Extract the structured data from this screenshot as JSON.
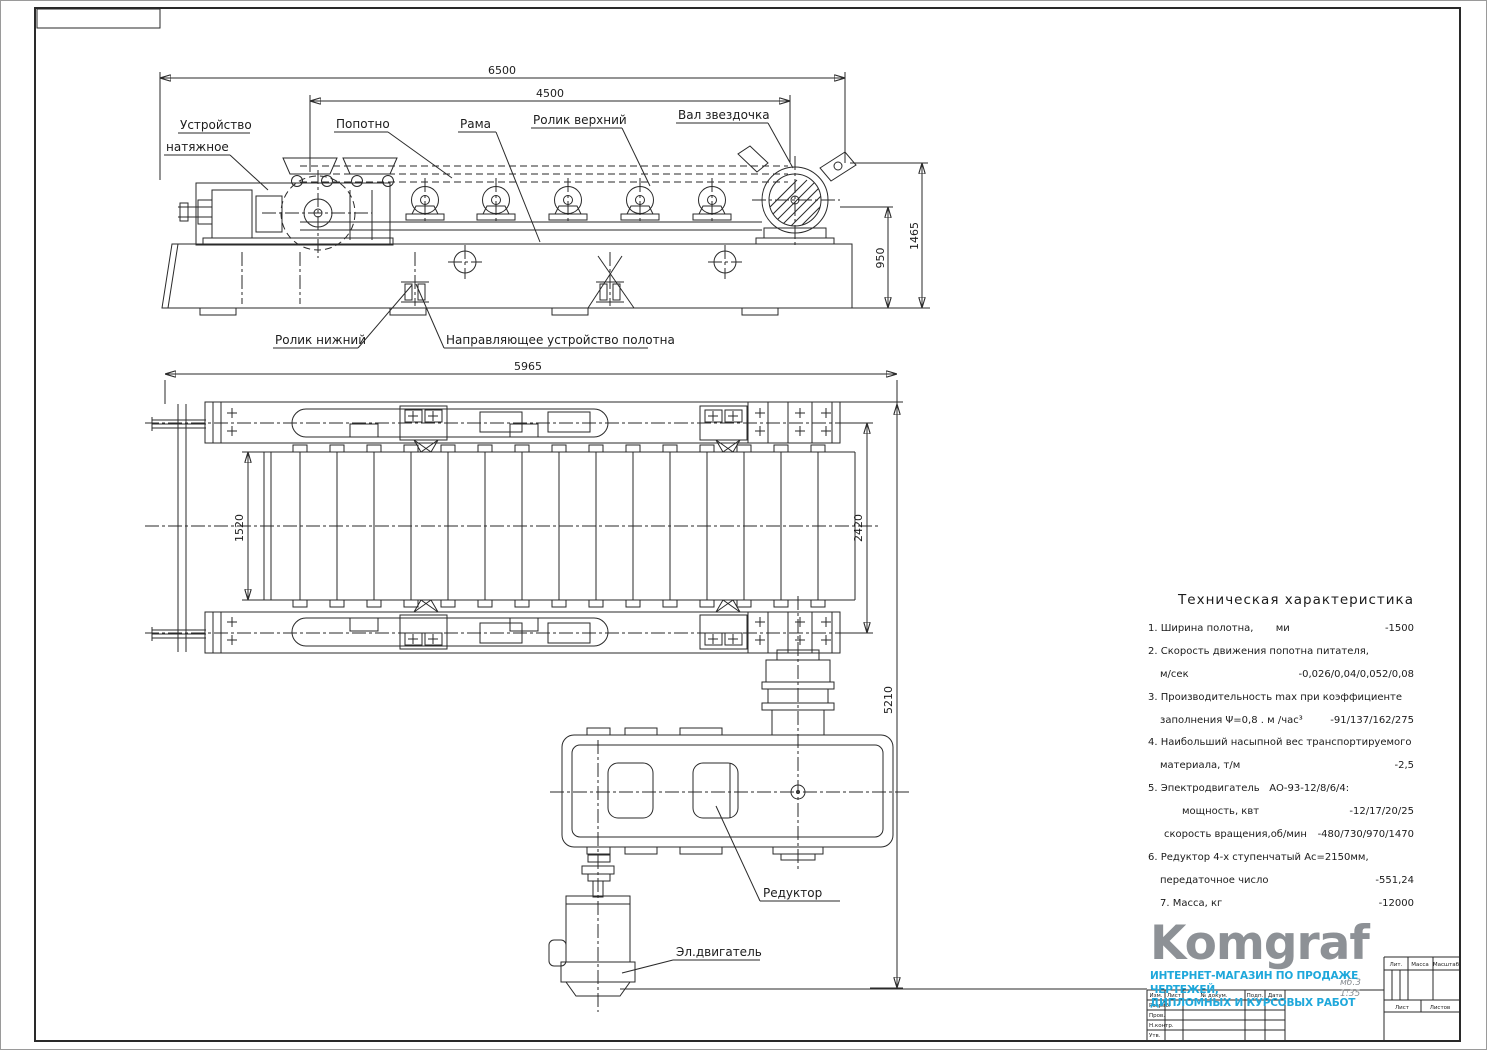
{
  "sheet": {
    "background": "#ffffff",
    "line_color": "#2a2a2a"
  },
  "drawing": {
    "labels": {
      "tension_device_line1": "Устройство",
      "tension_device_line2": "натяжное",
      "belt": "Попотно",
      "frame": "Рама",
      "roller_upper": "Ролик верхний",
      "sprocket_shaft": "Вал звездочка",
      "roller_lower": "Ролик нижний",
      "belt_guide": "Направляющее устройство полотна",
      "reducer": "Редуктор",
      "motor": "Эл.двигатель"
    },
    "dimensions": {
      "overall_length": "6500",
      "upper_span": "4500",
      "frame_height": "950",
      "total_height": "1465",
      "plan_length": "5965",
      "belt_width": "1520",
      "rail_span": "2420",
      "plan_total": "5210"
    }
  },
  "tech": {
    "title": "Техническая характеристика",
    "rows": [
      {
        "t": "1. Ширина полотна,       ми",
        "v": "-1500",
        "i": 0
      },
      {
        "t": "2. Скорость движения попотна питателя,",
        "v": "",
        "i": 0
      },
      {
        "t": "м/сек",
        "v": "-0,026/0,04/0,052/0,08",
        "i": 12
      },
      {
        "t": "3. Производительность max при коэффициенте",
        "v": "",
        "i": 0
      },
      {
        "t": "заполнения Ψ=0,8 . м /час³",
        "v": "-91/137/162/275",
        "i": 12
      },
      {
        "t": "4. Наибольший насыпной вес транспортируемого",
        "v": "",
        "i": 0
      },
      {
        "t": "материала, т/м",
        "v": "-2,5",
        "i": 12
      },
      {
        "t": "5. Эпектродвигатель   АО-93-12/8/6/4:",
        "v": "",
        "i": 0
      },
      {
        "t": "мощность, квт",
        "v": "-12/17/20/25",
        "i": 34
      },
      {
        "t": "скорость вращения,об/мин",
        "v": "-480/730/970/1470",
        "i": 16
      },
      {
        "t": "6. Редуктор 4-х ступенчатый Ас=2150мм,",
        "v": "",
        "i": 0
      },
      {
        "t": "передаточное число",
        "v": "-551,24",
        "i": 12
      },
      {
        "t": "7. Масса, кг",
        "v": "-12000",
        "i": 12
      }
    ]
  },
  "logo": {
    "name": "Komgraf",
    "line1": "ИНТЕРНЕТ-МАГАЗИН ПО ПРОДАЖЕ ЧЕРТЕЖЕЙ,",
    "line2": "ДИПЛОМНЫХ И КУРСОВЫХ РАБОТ",
    "note_line1": "мб.3",
    "note_line2": "1:35",
    "gray": "#8d9196",
    "blue": "#1fa8db"
  },
  "title_block": {
    "lit": "Лит.",
    "massa": "Масса",
    "masshtab": "Масштаб",
    "list": "Лист",
    "listov": "Листов",
    "header": [
      "Изм.",
      "Лист",
      "№ докум.",
      "Подп.",
      "Дата"
    ],
    "roles": [
      "Разраб.",
      "Пров.",
      "Н.контр.",
      "Утв."
    ]
  }
}
